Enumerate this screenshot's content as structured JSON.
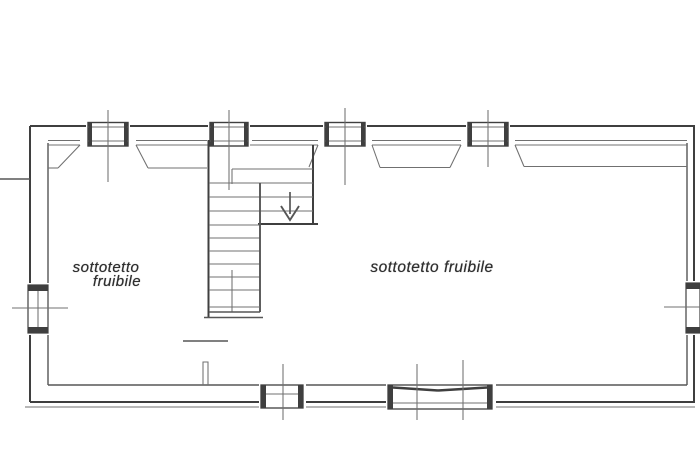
{
  "document": {
    "type": "architectural floor plan (attic level)",
    "background": "#ffffff"
  },
  "labels": {
    "left_room": {
      "line1": "sottotetto",
      "line2": "fruibile"
    },
    "right_room": {
      "text": "sottotetto fruibile"
    }
  },
  "icons": {
    "stair_arrow": "down-arrow"
  },
  "colors": {
    "bg": "#ffffff",
    "wall": "#3f3f3f",
    "line": "#565656",
    "thin": "#707070",
    "text": "#2f2f2f"
  }
}
